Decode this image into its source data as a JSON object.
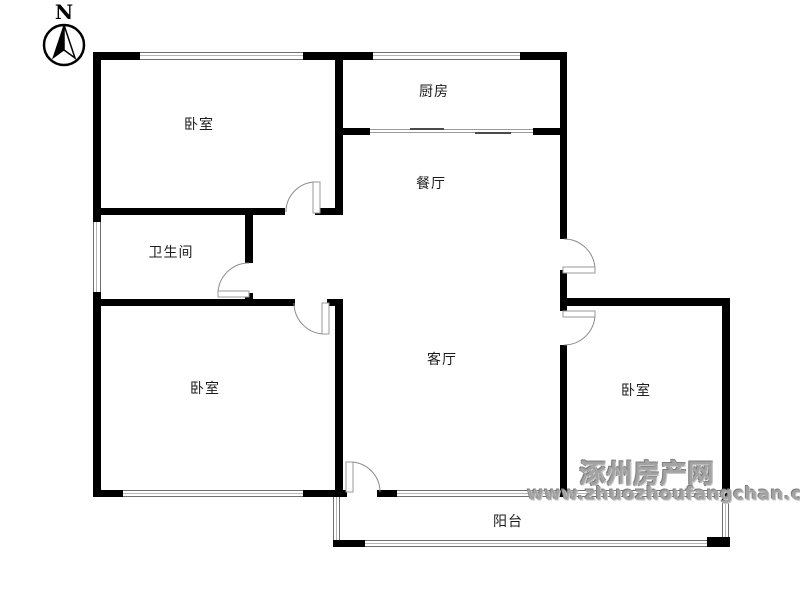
{
  "compass": {
    "label": "N"
  },
  "rooms": [
    {
      "id": "bedroom-top-left",
      "label": "卧室",
      "cx": 199,
      "cy": 124
    },
    {
      "id": "kitchen",
      "label": "厨房",
      "cx": 434,
      "cy": 91
    },
    {
      "id": "dining-room",
      "label": "餐厅",
      "cx": 431,
      "cy": 183
    },
    {
      "id": "bathroom",
      "label": "卫生间",
      "cx": 171,
      "cy": 252
    },
    {
      "id": "bedroom-bottom-left",
      "label": "卧室",
      "cx": 205,
      "cy": 388
    },
    {
      "id": "living-room",
      "label": "客厅",
      "cx": 442,
      "cy": 359
    },
    {
      "id": "bedroom-right",
      "label": "卧室",
      "cx": 636,
      "cy": 390
    },
    {
      "id": "balcony",
      "label": "阳台",
      "cx": 508,
      "cy": 521
    }
  ],
  "watermark": {
    "site_name": "涿州房产网",
    "site_url": "www.zhuozhoufangchan.com"
  },
  "colors": {
    "wall": "#000000",
    "window_line": "#6f6f6f",
    "door_line": "#8a8a8a",
    "label_text": "#1c1c1c",
    "watermark_gray": "#a3a3a3"
  },
  "geometry": {
    "walls": [
      [
        93,
        52,
        47,
        8
      ],
      [
        303,
        52,
        70,
        8
      ],
      [
        520,
        52,
        47,
        8
      ],
      [
        93,
        52,
        8,
        170
      ],
      [
        93,
        292,
        8,
        205
      ],
      [
        335,
        52,
        8,
        161
      ],
      [
        335,
        303,
        8,
        187
      ],
      [
        335,
        128,
        35,
        7
      ],
      [
        533,
        128,
        34,
        7
      ],
      [
        93,
        208,
        192,
        7
      ],
      [
        315,
        208,
        28,
        7
      ],
      [
        245,
        215,
        8,
        48
      ],
      [
        245,
        293,
        8,
        6
      ],
      [
        93,
        299,
        202,
        7
      ],
      [
        327,
        299,
        16,
        7
      ],
      [
        560,
        52,
        7,
        187
      ],
      [
        560,
        270,
        7,
        41
      ],
      [
        560,
        345,
        7,
        147
      ],
      [
        567,
        298,
        163,
        8
      ],
      [
        722,
        298,
        8,
        203
      ],
      [
        93,
        490,
        30,
        7
      ],
      [
        303,
        490,
        44,
        7
      ],
      [
        377,
        490,
        20,
        7
      ],
      [
        560,
        490,
        8,
        7
      ],
      [
        333,
        540,
        32,
        7
      ],
      [
        707,
        537,
        23,
        10
      ]
    ],
    "windows": [
      [
        140,
        52,
        163,
        8
      ],
      [
        373,
        52,
        147,
        8
      ],
      [
        123,
        490,
        180,
        7
      ],
      [
        397,
        490,
        163,
        7
      ],
      [
        568,
        490,
        154,
        7
      ],
      [
        365,
        540,
        342,
        7
      ],
      [
        93,
        222,
        8,
        70
      ],
      [
        333,
        497,
        7,
        43
      ],
      [
        722,
        503,
        7,
        34
      ]
    ],
    "sliding_door": {
      "x": 370,
      "y": 128,
      "w": 163,
      "h": 7,
      "rails": [
        1,
        4
      ],
      "panels": [
        [
          40,
          0,
          34
        ],
        [
          105,
          4,
          36
        ]
      ]
    },
    "doors": [
      {
        "id": "door-bedroom-top-left",
        "from": [
          286,
          212
        ],
        "to": [
          316,
          182
        ],
        "r": 30,
        "sweep": 1,
        "leaf": [
          313,
          182,
          7,
          31
        ]
      },
      {
        "id": "door-bathroom",
        "from": [
          249,
          263
        ],
        "to": [
          218,
          294
        ],
        "r": 31,
        "sweep": 0,
        "leaf": [
          218,
          291,
          31,
          6
        ]
      },
      {
        "id": "door-bedroom-bottom-left",
        "from": [
          294,
          303
        ],
        "to": [
          325,
          334
        ],
        "r": 31,
        "sweep": 0,
        "leaf": [
          322,
          303,
          7,
          31
        ]
      },
      {
        "id": "door-balcony",
        "from": [
          350,
          462
        ],
        "to": [
          380,
          492
        ],
        "r": 30,
        "sweep": 1,
        "leaf": [
          346,
          462,
          7,
          30
        ]
      },
      {
        "id": "door-entry",
        "from": [
          564,
          239
        ],
        "to": [
          595,
          270
        ],
        "r": 31,
        "sweep": 1,
        "leaf": [
          563,
          267,
          32,
          6
        ]
      },
      {
        "id": "door-bedroom-right",
        "from": [
          595,
          314
        ],
        "to": [
          564,
          345
        ],
        "r": 31,
        "sweep": 1,
        "leaf": [
          563,
          311,
          32,
          6
        ]
      }
    ],
    "compass": {
      "cx": 64,
      "cy": 45,
      "r": 20,
      "needle_left": "64,25 53,58 64,50",
      "needle_right": "64,25 75,58 64,50"
    }
  }
}
